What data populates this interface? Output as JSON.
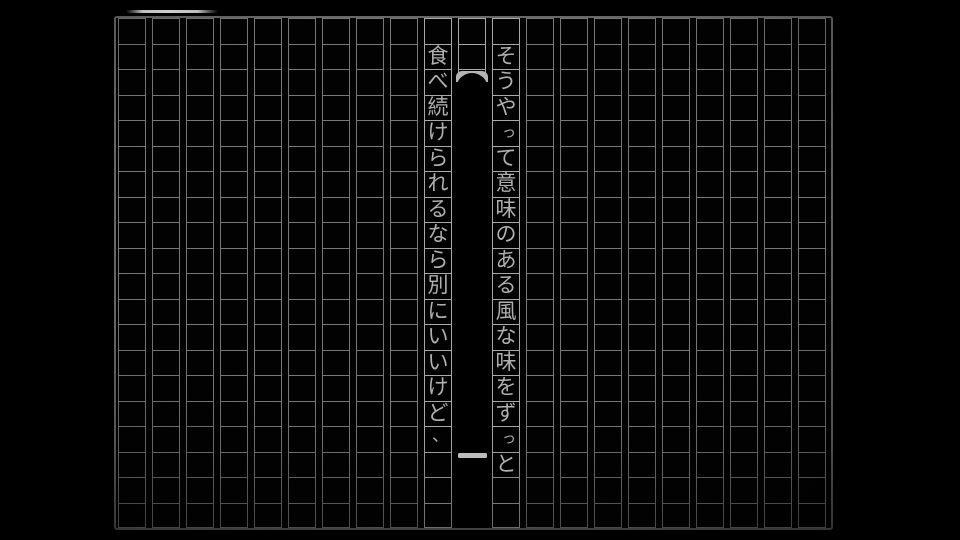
{
  "page": {
    "background_color": "#000000"
  },
  "manuscript": {
    "grid_columns": 21,
    "grid_rows": 20,
    "paper_background": "#020202",
    "frame_color": "#686868",
    "line_color": "#787878",
    "line_color_bright": "#a8a8a8",
    "text_color": "#b0b0b0"
  },
  "text": {
    "direction": "vertical-rl",
    "columns": [
      {
        "side": "right",
        "grid_index": 11,
        "start_row": 1,
        "string": "そうやって意味のある風な味をずっと",
        "chars": [
          "そ",
          "う",
          "や",
          "っ",
          "て",
          "意",
          "味",
          "の",
          "あ",
          "る",
          "風",
          "な",
          "味",
          "を",
          "ず",
          "っ",
          "と"
        ]
      },
      {
        "side": "left",
        "grid_index": 9,
        "start_row": 1,
        "string": "食べ続けられるなら別にいいけど、",
        "chars": [
          "食",
          "べ",
          "続",
          "け",
          "ら",
          "れ",
          "る",
          "な",
          "ら",
          "別",
          "に",
          "い",
          "い",
          "け",
          "ど",
          "、"
        ]
      }
    ]
  },
  "censor": {
    "grid_index": 10,
    "fill_color": "#000000",
    "cap_color": "#b4b4b4",
    "bar_color": "#bcbcbc"
  },
  "tab": {
    "highlight_color": "#bdbdbd"
  }
}
